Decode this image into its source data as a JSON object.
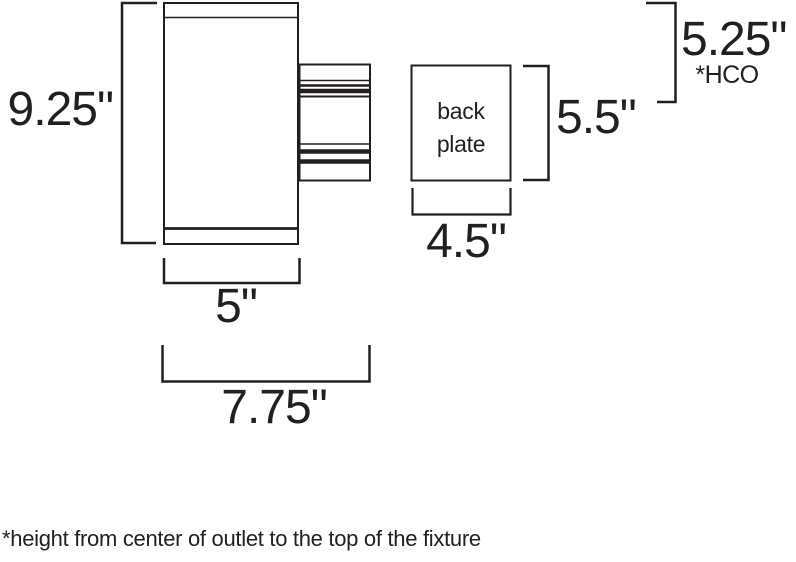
{
  "diagram": {
    "fixture": {
      "height_label": "9.25\"",
      "body_width_label": "5\"",
      "overall_depth_label": "7.75\"",
      "backplate": {
        "line1": "back",
        "line2": "plate",
        "width_label": "4.5\"",
        "height_label": "5.5\""
      },
      "hco": {
        "value": "5.25\"",
        "tag": "*HCO"
      }
    },
    "footnote": "*height from center of outlet to the top of the fixture"
  },
  "colors": {
    "line": "#231f20",
    "bg": "#ffffff"
  }
}
